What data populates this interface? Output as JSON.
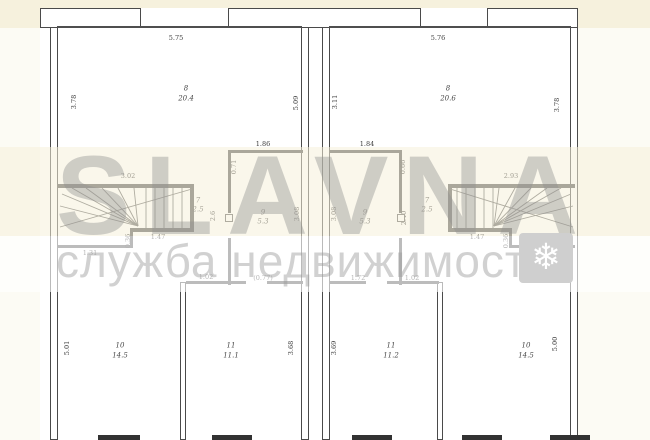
{
  "watermark": {
    "brand": "SLAVNA",
    "tagline": "служба недвижимости",
    "snowflake_icon": "❄"
  },
  "colors": {
    "background_cream": "#f6f1dd",
    "paper_white": "#ffffff",
    "wall_gray": "#4f4f4f",
    "watermark_gray": "#9a9a9a",
    "snowflake_box_gray": "#cfcfcf"
  },
  "plan": {
    "type": "floor-plan",
    "description": "Mirrored duplex townhouse floor plan, two symmetric units with winder staircases",
    "rooms": [
      {
        "unit": "left",
        "number": "8",
        "area": "20.4"
      },
      {
        "unit": "left",
        "number": "7",
        "area": "2.5"
      },
      {
        "unit": "left",
        "number": "9",
        "area": "5.3"
      },
      {
        "unit": "left",
        "number": "10",
        "area": "14.5"
      },
      {
        "unit": "left",
        "number": "11",
        "area": "11.1"
      },
      {
        "unit": "right",
        "number": "8",
        "area": "20.6"
      },
      {
        "unit": "right",
        "number": "7",
        "area": "2.5"
      },
      {
        "unit": "right",
        "number": "9",
        "area": "5.3"
      },
      {
        "unit": "right",
        "number": "11",
        "area": "11.2"
      },
      {
        "unit": "right",
        "number": "10",
        "area": "14.5"
      }
    ],
    "labels": [
      {
        "u": "left",
        "k": "dim",
        "t": "5.75",
        "x": 176,
        "y": 38
      },
      {
        "u": "left",
        "k": "dim",
        "t": "3.78",
        "x": 74,
        "y": 102,
        "r": 1
      },
      {
        "u": "left",
        "k": "dim",
        "t": "5.09",
        "x": 296,
        "y": 103,
        "r": 1
      },
      {
        "u": "left",
        "k": "num",
        "t": "8",
        "x": 186,
        "y": 89
      },
      {
        "u": "left",
        "k": "area",
        "t": "20.4",
        "x": 186,
        "y": 99
      },
      {
        "u": "left",
        "k": "dim",
        "t": "3.02",
        "x": 128,
        "y": 176
      },
      {
        "u": "left",
        "k": "dim",
        "t": "1.86",
        "x": 263,
        "y": 144
      },
      {
        "u": "left",
        "k": "dim",
        "t": "0.71",
        "x": 234,
        "y": 167,
        "r": 1
      },
      {
        "u": "left",
        "k": "num",
        "t": "7",
        "x": 198,
        "y": 201
      },
      {
        "u": "left",
        "k": "area",
        "t": "2.5",
        "x": 198,
        "y": 210
      },
      {
        "u": "left",
        "k": "dim",
        "t": "2.6",
        "x": 213,
        "y": 216,
        "r": 1
      },
      {
        "u": "left",
        "k": "num",
        "t": "9",
        "x": 263,
        "y": 213
      },
      {
        "u": "left",
        "k": "area",
        "t": "5.3",
        "x": 263,
        "y": 222
      },
      {
        "u": "left",
        "k": "dim",
        "t": "3.08",
        "x": 297,
        "y": 214,
        "r": 1
      },
      {
        "u": "left",
        "k": "dim",
        "t": "1.47",
        "x": 158,
        "y": 237
      },
      {
        "u": "left",
        "k": "dim",
        "t": "0.36",
        "x": 128,
        "y": 241,
        "r": 1
      },
      {
        "u": "left",
        "k": "dim",
        "t": "1.31",
        "x": 90,
        "y": 253
      },
      {
        "u": "left",
        "k": "dim",
        "t": "1.02",
        "x": 206,
        "y": 277
      },
      {
        "u": "left",
        "k": "dim",
        "t": "(0.77)",
        "x": 263,
        "y": 278
      },
      {
        "u": "left",
        "k": "num",
        "t": "10",
        "x": 120,
        "y": 346
      },
      {
        "u": "left",
        "k": "area",
        "t": "14.5",
        "x": 120,
        "y": 356
      },
      {
        "u": "left",
        "k": "dim",
        "t": "5.01",
        "x": 67,
        "y": 348,
        "r": 1
      },
      {
        "u": "left",
        "k": "num",
        "t": "11",
        "x": 231,
        "y": 346
      },
      {
        "u": "left",
        "k": "area",
        "t": "11.1",
        "x": 231,
        "y": 356
      },
      {
        "u": "left",
        "k": "dim",
        "t": "3.68",
        "x": 291,
        "y": 348,
        "r": 1
      },
      {
        "u": "right",
        "k": "dim",
        "t": "5.76",
        "x": 438,
        "y": 38
      },
      {
        "u": "right",
        "k": "dim",
        "t": "3.11",
        "x": 335,
        "y": 102,
        "r": 1
      },
      {
        "u": "right",
        "k": "dim",
        "t": "3.78",
        "x": 557,
        "y": 105,
        "r": 1
      },
      {
        "u": "right",
        "k": "num",
        "t": "8",
        "x": 448,
        "y": 89
      },
      {
        "u": "right",
        "k": "area",
        "t": "20.6",
        "x": 448,
        "y": 99
      },
      {
        "u": "right",
        "k": "dim",
        "t": "2.93",
        "x": 511,
        "y": 176
      },
      {
        "u": "right",
        "k": "dim",
        "t": "1.84",
        "x": 367,
        "y": 144
      },
      {
        "u": "right",
        "k": "dim",
        "t": "0.66",
        "x": 403,
        "y": 167,
        "r": 1
      },
      {
        "u": "right",
        "k": "num",
        "t": "9",
        "x": 365,
        "y": 213
      },
      {
        "u": "right",
        "k": "area",
        "t": "5.3",
        "x": 365,
        "y": 222
      },
      {
        "u": "right",
        "k": "dim",
        "t": "3.08",
        "x": 334,
        "y": 214,
        "r": 1
      },
      {
        "u": "right",
        "k": "dim",
        "t": "2.40",
        "x": 404,
        "y": 218,
        "r": 1
      },
      {
        "u": "right",
        "k": "num",
        "t": "7",
        "x": 427,
        "y": 201
      },
      {
        "u": "right",
        "k": "area",
        "t": "2.5",
        "x": 427,
        "y": 210
      },
      {
        "u": "right",
        "k": "dim",
        "t": "1.47",
        "x": 477,
        "y": 237
      },
      {
        "u": "right",
        "k": "dim",
        "t": "0.36",
        "x": 506,
        "y": 241,
        "r": 1
      },
      {
        "u": "right",
        "k": "dim",
        "t": "1.29",
        "x": 530,
        "y": 253
      },
      {
        "u": "right",
        "k": "dim",
        "t": "1.72",
        "x": 358,
        "y": 278
      },
      {
        "u": "right",
        "k": "dim",
        "t": "1.02",
        "x": 412,
        "y": 278
      },
      {
        "u": "right",
        "k": "num",
        "t": "11",
        "x": 391,
        "y": 346
      },
      {
        "u": "right",
        "k": "area",
        "t": "11.2",
        "x": 391,
        "y": 356
      },
      {
        "u": "right",
        "k": "dim",
        "t": "3.69",
        "x": 334,
        "y": 348,
        "r": 1
      },
      {
        "u": "right",
        "k": "num",
        "t": "10",
        "x": 526,
        "y": 346
      },
      {
        "u": "right",
        "k": "area",
        "t": "14.5",
        "x": 526,
        "y": 356
      },
      {
        "u": "right",
        "k": "dim",
        "t": "5.00",
        "x": 555,
        "y": 344,
        "r": 1
      }
    ]
  }
}
